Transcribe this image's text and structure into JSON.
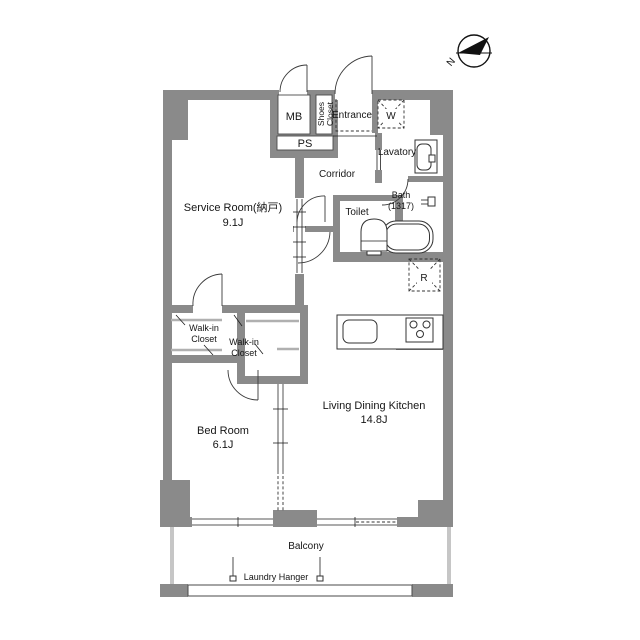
{
  "floorplan": {
    "compass": {
      "north_label": "N"
    },
    "rooms": {
      "service_room": {
        "label": "Service Room(納戸)",
        "area": "9.1J"
      },
      "bed_room": {
        "label": "Bed Room",
        "area": "6.1J"
      },
      "ldk": {
        "label": "Living Dining Kitchen",
        "area": "14.8J"
      },
      "walk_in_closet_1": {
        "line1": "Walk-in",
        "line2": "Closet"
      },
      "walk_in_closet_2": {
        "line1": "Walk-in",
        "line2": "Closet"
      },
      "corridor": {
        "label": "Corridor"
      },
      "entrance": {
        "label": "Entrance"
      },
      "lavatory": {
        "label": "Lavatory"
      },
      "toilet": {
        "label": "Toilet"
      },
      "bath": {
        "label": "Bath",
        "size": "(1317)"
      },
      "balcony": {
        "label": "Balcony"
      },
      "laundry_hanger": {
        "label": "Laundry Hanger"
      },
      "meter_box": {
        "label": "MB"
      },
      "pipe_space": {
        "label": "PS"
      },
      "shoes_closet": {
        "line1": "Shoes",
        "line2": "Closet"
      },
      "washer": {
        "label": "W"
      },
      "fridge": {
        "label": "R"
      }
    },
    "colors": {
      "bg": "#ffffff",
      "wall": "#8a8a8a",
      "line": "#1f1f1f",
      "light": "#b0b0b0",
      "rail": "#c6c6c6"
    }
  }
}
